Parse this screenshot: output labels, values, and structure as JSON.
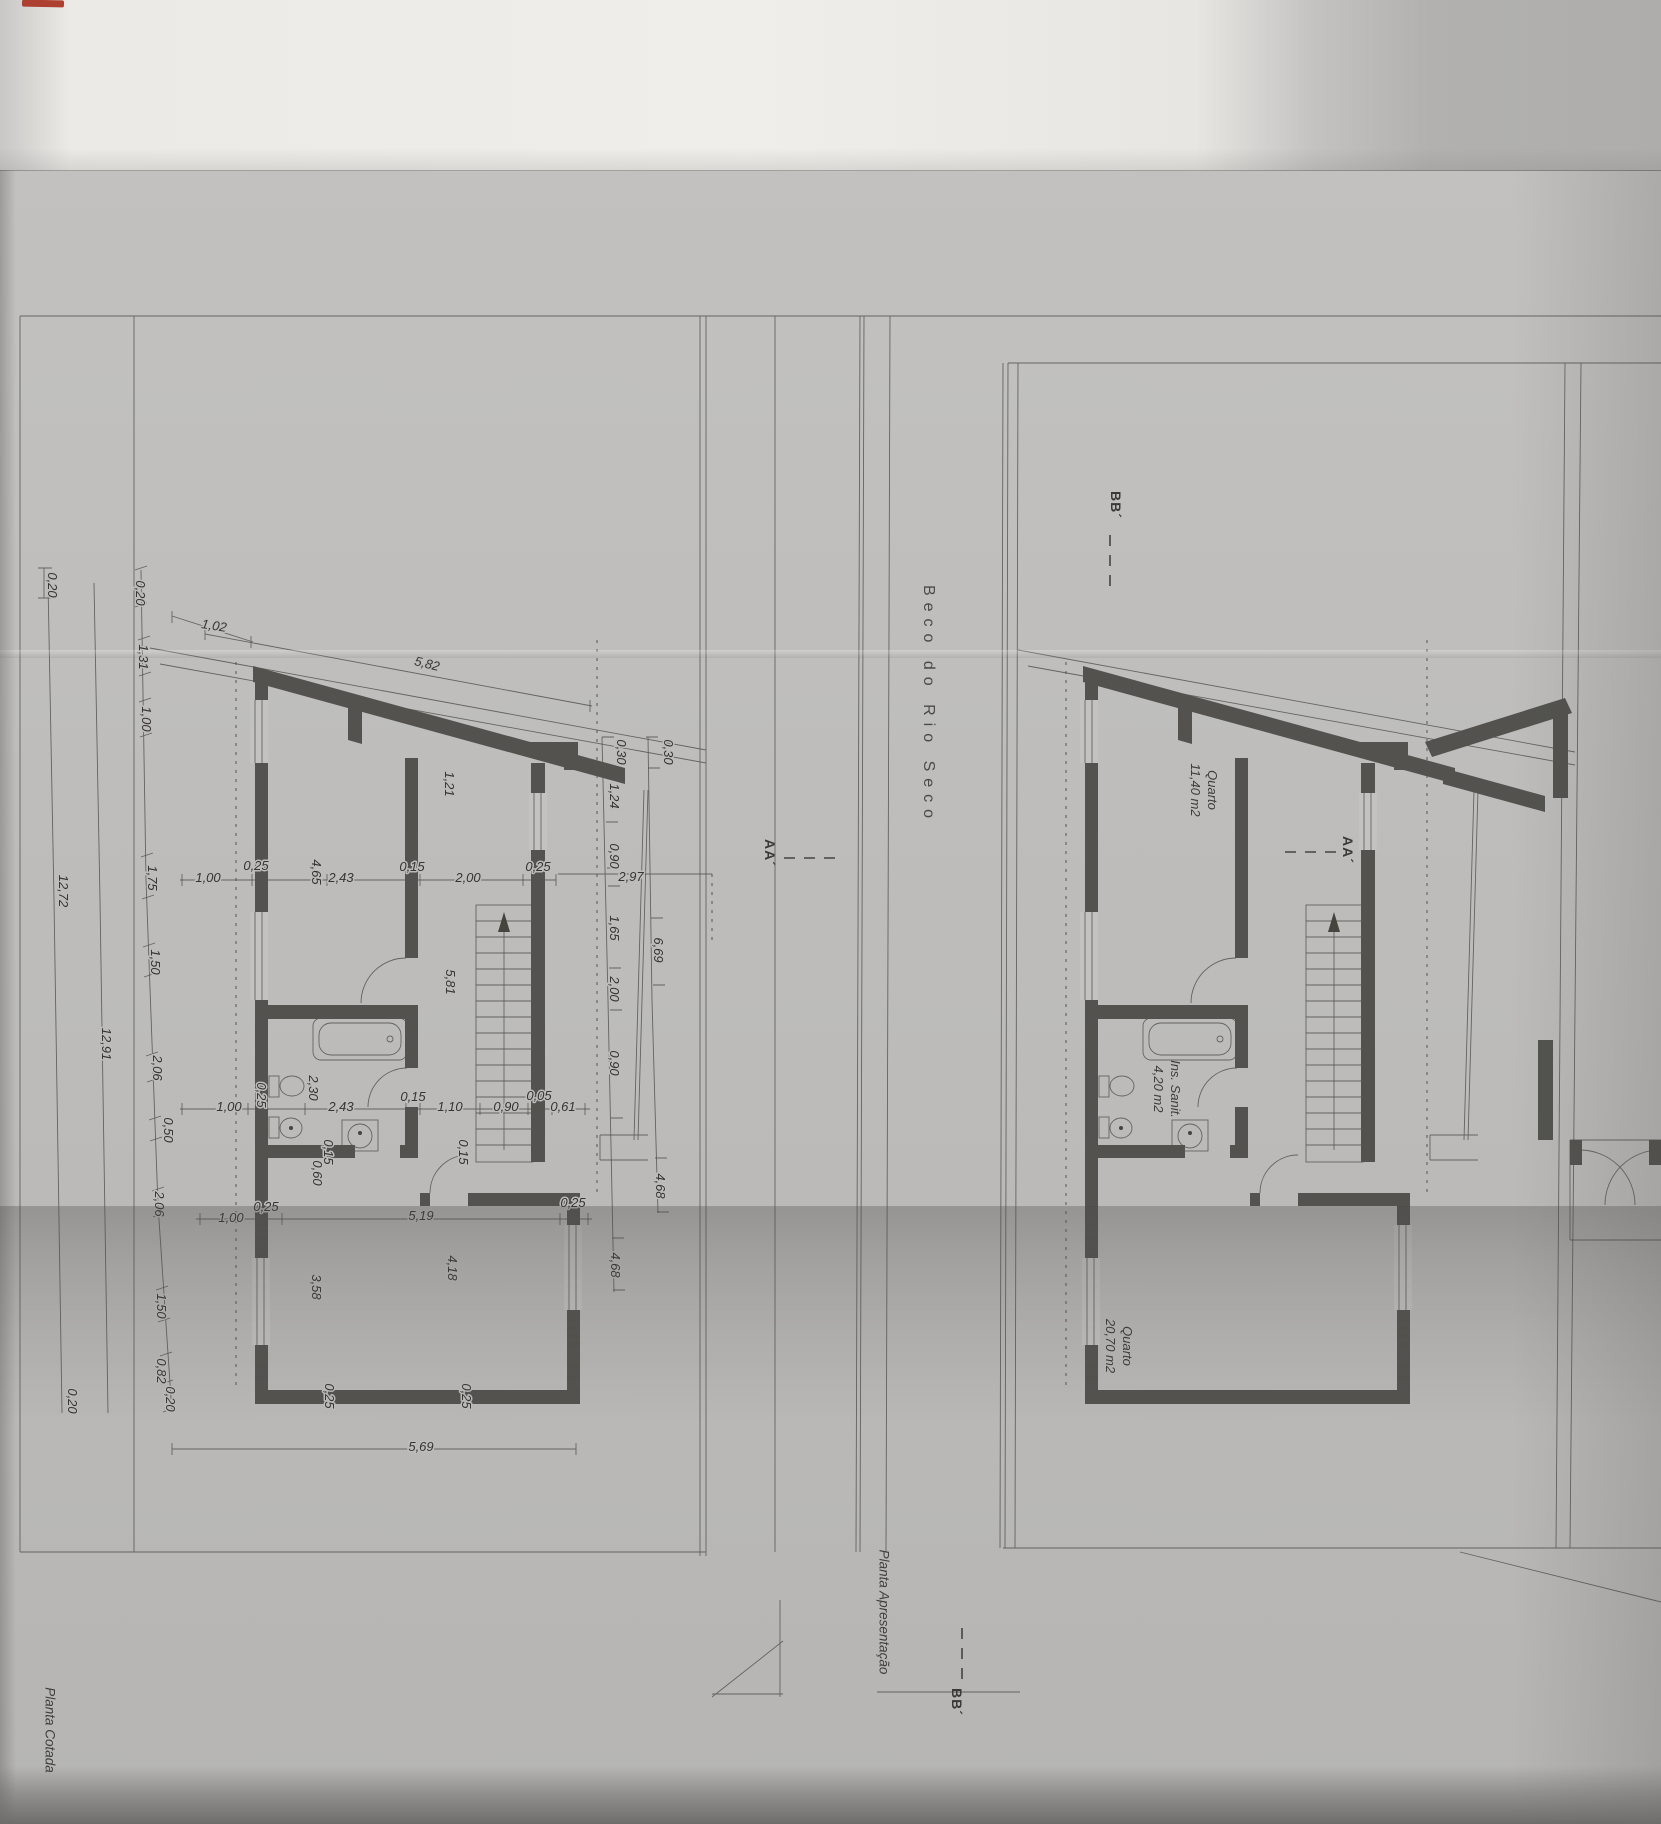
{
  "titles": {
    "left_plan": "Planta Cotada",
    "right_plan": "Planta Apresentação",
    "street": "Beco do Rio Seco"
  },
  "rooms": [
    {
      "name": "Quarto",
      "area": "11,40 m2",
      "x": 1204,
      "y": 790
    },
    {
      "name": "Ins. Sanit.",
      "area": "4,20 m2",
      "x": 1167,
      "y": 1089
    },
    {
      "name": "Quarto",
      "area": "20,70 m2",
      "x": 1119,
      "y": 1346
    }
  ],
  "section_markers": {
    "bb_top": "BB´",
    "bb_bottom": "BB´",
    "aa_left": "AA´",
    "aa_right": "AA´"
  },
  "dimensions": [
    {
      "t": "1,02",
      "x": 214,
      "y": 626,
      "r": 9
    },
    {
      "t": "5,82",
      "x": 427,
      "y": 664,
      "r": 14
    },
    {
      "t": "0,20",
      "x": 52,
      "y": 585,
      "r": 90
    },
    {
      "t": "0,20",
      "x": 140,
      "y": 593,
      "r": 90
    },
    {
      "t": "1,31",
      "x": 143,
      "y": 657,
      "r": 90
    },
    {
      "t": "1,00",
      "x": 146,
      "y": 719,
      "r": 90
    },
    {
      "t": "1,75",
      "x": 152,
      "y": 878,
      "r": 90
    },
    {
      "t": "1,50",
      "x": 155,
      "y": 962,
      "r": 90
    },
    {
      "t": "2,06",
      "x": 157,
      "y": 1068,
      "r": 90
    },
    {
      "t": "0,50",
      "x": 168,
      "y": 1130,
      "r": 90
    },
    {
      "t": "2,06",
      "x": 159,
      "y": 1204,
      "r": 90
    },
    {
      "t": "1,50",
      "x": 161,
      "y": 1306,
      "r": 90
    },
    {
      "t": "0,82",
      "x": 161,
      "y": 1371,
      "r": 90
    },
    {
      "t": "0,20",
      "x": 170,
      "y": 1399,
      "r": 90
    },
    {
      "t": "12,91",
      "x": 106,
      "y": 1044,
      "r": 90
    },
    {
      "t": "12,72",
      "x": 63,
      "y": 891,
      "r": 90
    },
    {
      "t": "0,20",
      "x": 72,
      "y": 1401,
      "r": 90
    },
    {
      "t": "1,00",
      "x": 208,
      "y": 878,
      "r": 0
    },
    {
      "t": "0,25",
      "x": 256,
      "y": 866,
      "r": 0
    },
    {
      "t": "4,65",
      "x": 316,
      "y": 872,
      "r": 90
    },
    {
      "t": "2,43",
      "x": 341,
      "y": 878,
      "r": 0
    },
    {
      "t": "0,15",
      "x": 412,
      "y": 867,
      "r": 0
    },
    {
      "t": "2,00",
      "x": 468,
      "y": 878,
      "r": 0
    },
    {
      "t": "0,25",
      "x": 538,
      "y": 867,
      "r": 0
    },
    {
      "t": "1,21",
      "x": 449,
      "y": 784,
      "r": 90
    },
    {
      "t": "0,30",
      "x": 621,
      "y": 752,
      "r": 90
    },
    {
      "t": "0,30",
      "x": 668,
      "y": 752,
      "r": 90
    },
    {
      "t": "1,24",
      "x": 614,
      "y": 796,
      "r": 90
    },
    {
      "t": "0,90",
      "x": 614,
      "y": 856,
      "r": 90
    },
    {
      "t": "2,97",
      "x": 631,
      "y": 877,
      "r": 0
    },
    {
      "t": "1,65",
      "x": 614,
      "y": 928,
      "r": 90
    },
    {
      "t": "6,69",
      "x": 658,
      "y": 950,
      "r": 90
    },
    {
      "t": "2,00",
      "x": 614,
      "y": 989,
      "r": 90
    },
    {
      "t": "5,81",
      "x": 450,
      "y": 982,
      "r": 90
    },
    {
      "t": "0,90",
      "x": 614,
      "y": 1063,
      "r": 90
    },
    {
      "t": "1,00",
      "x": 229,
      "y": 1107,
      "r": 0
    },
    {
      "t": "0,25",
      "x": 261,
      "y": 1095,
      "r": 90
    },
    {
      "t": "2,30",
      "x": 313,
      "y": 1088,
      "r": 90
    },
    {
      "t": "2,43",
      "x": 341,
      "y": 1107,
      "r": 0
    },
    {
      "t": "0,15",
      "x": 413,
      "y": 1097,
      "r": 0
    },
    {
      "t": "1,10",
      "x": 450,
      "y": 1107,
      "r": 0
    },
    {
      "t": "0,90",
      "x": 506,
      "y": 1107,
      "r": 0
    },
    {
      "t": "0,05",
      "x": 539,
      "y": 1096,
      "r": 0
    },
    {
      "t": "0,61",
      "x": 563,
      "y": 1107,
      "r": 0
    },
    {
      "t": "0,15",
      "x": 328,
      "y": 1152,
      "r": 90
    },
    {
      "t": "0,60",
      "x": 317,
      "y": 1173,
      "r": 90
    },
    {
      "t": "0,15",
      "x": 463,
      "y": 1152,
      "r": 90
    },
    {
      "t": "1,00",
      "x": 231,
      "y": 1218,
      "r": 0
    },
    {
      "t": "0,25",
      "x": 266,
      "y": 1207,
      "r": 0
    },
    {
      "t": "5,19",
      "x": 421,
      "y": 1216,
      "r": 0
    },
    {
      "t": "0,25",
      "x": 573,
      "y": 1203,
      "r": 0
    },
    {
      "t": "3,58",
      "x": 316,
      "y": 1287,
      "r": 90
    },
    {
      "t": "4,18",
      "x": 452,
      "y": 1268,
      "r": 90
    },
    {
      "t": "4,68",
      "x": 615,
      "y": 1265,
      "r": 90
    },
    {
      "t": "4,68",
      "x": 660,
      "y": 1186,
      "r": 90
    },
    {
      "t": "0,25",
      "x": 329,
      "y": 1396,
      "r": 90
    },
    {
      "t": "0,25",
      "x": 466,
      "y": 1396,
      "r": 90
    },
    {
      "t": "5,69",
      "x": 421,
      "y": 1447,
      "r": 0
    }
  ],
  "colors": {
    "paper": "#bdbcba",
    "ink": "#45443f",
    "wall": "#53524e",
    "highlight": "#f0eeea",
    "red_mark": "#ad4030"
  }
}
